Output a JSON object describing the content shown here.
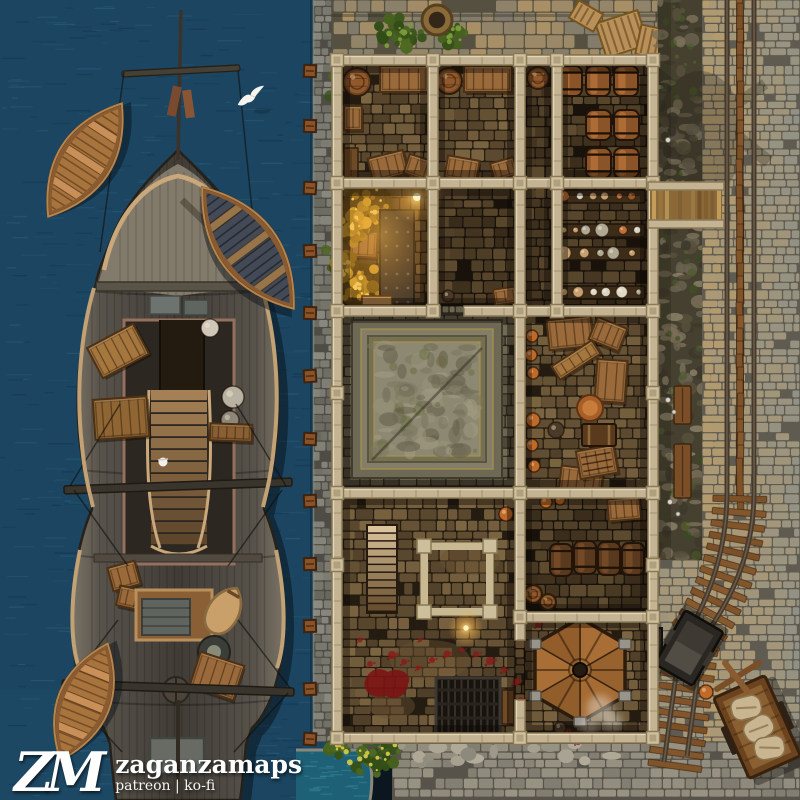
{
  "watermark": {
    "logo": "ZM",
    "name": "zaganzamaps",
    "links": "patreon | ko-fi"
  },
  "palette": {
    "water": "#1b4560",
    "water_light": "#2e5f7e",
    "water_dark": "#12344c",
    "inlet": "#1e6075",
    "stone_light": "#8b8a80",
    "stone_dark": "#66655c",
    "street_warm": "#b49b6e",
    "street_grey": "#8e9087",
    "beam": "#c4b494",
    "beam_edge": "#8a7a56",
    "barrel": "#8a5a2e",
    "crate": "#9a6a3a",
    "hay": "#d9a62f",
    "blood": "#8c1818",
    "rail": "#453a2e",
    "tie": "#7a4e26",
    "hull": "#4f4a3f",
    "boat": "#a8743e",
    "rig_tan": "#c9a87c"
  },
  "features": {
    "mooring_post_ys": [
      65,
      120,
      182,
      245,
      307,
      370,
      433,
      495,
      558,
      620,
      683,
      733
    ],
    "rooms": [
      {
        "x": 342,
        "y": 65,
        "w": 86,
        "h": 113,
        "pal": "warm"
      },
      {
        "x": 437,
        "y": 65,
        "w": 78,
        "h": 113,
        "pal": "warm"
      },
      {
        "x": 524,
        "y": 65,
        "w": 28,
        "h": 241,
        "pal": "dark"
      },
      {
        "x": 560,
        "y": 65,
        "w": 88,
        "h": 113,
        "pal": "dark"
      },
      {
        "x": 342,
        "y": 188,
        "w": 86,
        "h": 118,
        "pal": "stable"
      },
      {
        "x": 437,
        "y": 188,
        "w": 78,
        "h": 118,
        "pal": "dark"
      },
      {
        "x": 560,
        "y": 188,
        "w": 88,
        "h": 118,
        "pal": "dark"
      },
      {
        "x": 342,
        "y": 315,
        "w": 173,
        "h": 173,
        "pal": "court"
      },
      {
        "x": 524,
        "y": 315,
        "w": 124,
        "h": 173,
        "pal": "warm"
      },
      {
        "x": 342,
        "y": 497,
        "w": 173,
        "h": 236,
        "pal": "warm"
      },
      {
        "x": 524,
        "y": 497,
        "w": 124,
        "h": 115,
        "pal": "dark"
      },
      {
        "x": 524,
        "y": 620,
        "w": 124,
        "h": 113,
        "pal": "warm"
      }
    ],
    "walls": {
      "h": [
        [
          332,
          55,
          326
        ],
        [
          332,
          178,
          326
        ],
        [
          332,
          306,
          108
        ],
        [
          464,
          306,
          194
        ],
        [
          332,
          488,
          326
        ],
        [
          515,
          612,
          143
        ],
        [
          332,
          733,
          326
        ]
      ],
      "v": [
        [
          332,
          55,
          688
        ],
        [
          648,
          55,
          688
        ],
        [
          428,
          55,
          261
        ],
        [
          552,
          55,
          261
        ],
        [
          515,
          55,
          585
        ],
        [
          515,
          700,
          33
        ]
      ],
      "posts": [
        [
          332,
          55
        ],
        [
          428,
          55
        ],
        [
          515,
          55
        ],
        [
          552,
          55
        ],
        [
          648,
          55
        ],
        [
          332,
          178
        ],
        [
          428,
          178
        ],
        [
          515,
          178
        ],
        [
          552,
          178
        ],
        [
          648,
          178
        ],
        [
          332,
          306
        ],
        [
          428,
          306
        ],
        [
          515,
          306
        ],
        [
          552,
          306
        ],
        [
          648,
          306
        ],
        [
          332,
          488
        ],
        [
          515,
          488
        ],
        [
          648,
          488
        ],
        [
          515,
          612
        ],
        [
          648,
          612
        ],
        [
          332,
          733
        ],
        [
          515,
          733
        ],
        [
          648,
          733
        ],
        [
          332,
          388
        ],
        [
          648,
          388
        ],
        [
          332,
          560
        ],
        [
          648,
          560
        ]
      ]
    },
    "barrel_tops": [
      [
        357,
        82,
        14
      ],
      [
        449,
        81,
        13
      ],
      [
        538,
        78,
        11
      ],
      [
        533,
        594,
        9
      ],
      [
        548,
        602,
        8
      ]
    ],
    "barrels_upright": [
      [
        558,
        66,
        24,
        30
      ],
      [
        586,
        66,
        24,
        30
      ],
      [
        614,
        66,
        24,
        30
      ],
      [
        586,
        110,
        25,
        30
      ],
      [
        614,
        110,
        25,
        30
      ],
      [
        586,
        148,
        25,
        30
      ],
      [
        614,
        148,
        25,
        30
      ]
    ],
    "barrels_dark": [
      [
        550,
        544,
        22,
        32
      ],
      [
        574,
        541,
        22,
        33
      ],
      [
        598,
        542,
        22,
        33
      ],
      [
        622,
        543,
        22,
        32
      ]
    ],
    "crates": [
      [
        380,
        66,
        48,
        26,
        0
      ],
      [
        344,
        106,
        18,
        24,
        0
      ],
      [
        370,
        154,
        36,
        24,
        -14
      ],
      [
        406,
        158,
        30,
        20,
        18
      ],
      [
        464,
        66,
        48,
        26,
        0
      ],
      [
        446,
        158,
        32,
        22,
        10
      ],
      [
        492,
        160,
        24,
        18,
        -16
      ],
      [
        350,
        231,
        27,
        26,
        3
      ],
      [
        548,
        318,
        44,
        30,
        -6
      ],
      [
        592,
        322,
        32,
        24,
        22
      ],
      [
        596,
        360,
        30,
        42,
        4
      ],
      [
        560,
        468,
        42,
        26,
        7
      ],
      [
        608,
        498,
        32,
        22,
        -5
      ],
      [
        494,
        288,
        22,
        16,
        -8
      ]
    ],
    "crate_grids": [
      [
        578,
        448,
        38,
        28,
        -10
      ]
    ],
    "chests": [
      [
        582,
        424,
        34,
        22
      ]
    ],
    "copper_bowl": [
      590,
      408,
      13
    ],
    "bench_items": [
      [
        552,
        352,
        48,
        16,
        -33
      ]
    ],
    "shelf_rows": [
      [
        557,
        190,
        88
      ],
      [
        557,
        224,
        88
      ],
      [
        557,
        247,
        88
      ],
      [
        557,
        286,
        88
      ]
    ],
    "hay_clusters": [
      [
        368,
        208,
        26
      ],
      [
        352,
        228,
        17
      ],
      [
        360,
        284,
        24
      ],
      [
        344,
        266,
        15
      ]
    ],
    "metal_wall": [
      380,
      210,
      34,
      94
    ],
    "stable_sign": [
      362,
      296,
      30,
      9
    ],
    "doors": [
      [
        344,
        148,
        14,
        30
      ],
      [
        502,
        690,
        12,
        34
      ]
    ],
    "glow_points": [
      [
        417,
        197,
        9
      ],
      [
        466,
        628,
        6
      ]
    ],
    "stairs": [
      368,
      526,
      28,
      86
    ],
    "frame_square": [
      424,
      546,
      66,
      66
    ],
    "grate_rect": [
      436,
      678,
      64,
      56
    ],
    "hexagon": [
      580,
      670,
      52
    ],
    "platform": [
      352,
      320,
      150,
      158
    ],
    "pots_orange": [
      [
        532,
        336,
        6
      ],
      [
        531,
        355,
        6
      ],
      [
        533,
        373,
        6
      ],
      [
        533,
        420,
        7
      ],
      [
        532,
        445,
        6
      ],
      [
        534,
        466,
        6
      ],
      [
        546,
        502,
        6
      ],
      [
        560,
        500,
        5
      ],
      [
        506,
        514,
        7
      ],
      [
        706,
        692,
        7
      ]
    ],
    "pots_dark": [
      [
        556,
        430,
        8
      ],
      [
        560,
        728,
        6
      ],
      [
        448,
        296,
        6
      ]
    ],
    "blood_pool": [
      388,
      684
    ],
    "blood_splats": [
      [
        392,
        655,
        4
      ],
      [
        404,
        662,
        3
      ],
      [
        418,
        668,
        2.5
      ],
      [
        432,
        660,
        3
      ],
      [
        447,
        654,
        3.5
      ],
      [
        462,
        650,
        2.5
      ],
      [
        476,
        654,
        3
      ],
      [
        490,
        661,
        4
      ],
      [
        504,
        670,
        3
      ],
      [
        516,
        682,
        3.5
      ],
      [
        521,
        700,
        3
      ],
      [
        538,
        625,
        3
      ],
      [
        552,
        618,
        2.5
      ],
      [
        565,
        731,
        3.5
      ],
      [
        578,
        742,
        3
      ],
      [
        420,
        640,
        2
      ],
      [
        370,
        664,
        3
      ],
      [
        360,
        640,
        2.5
      ]
    ],
    "dirt_patches": [
      [
        430,
        660,
        80,
        40
      ],
      [
        392,
        706,
        46,
        26
      ],
      [
        470,
        560,
        60,
        30
      ]
    ],
    "smoke_puffs": [
      [
        600,
        708,
        13
      ],
      [
        612,
        722,
        10
      ],
      [
        590,
        726,
        9
      ]
    ],
    "street_benches": [
      [
        674,
        386,
        17,
        38
      ],
      [
        674,
        444,
        17,
        54
      ]
    ],
    "mushrooms": [
      [
        668,
        400,
        2.5
      ],
      [
        674,
        412,
        2
      ],
      [
        670,
        502,
        2.5
      ],
      [
        678,
        514,
        2
      ],
      [
        668,
        140,
        2.5
      ]
    ],
    "track": {
      "straight_x": 740,
      "curve": [
        [
          740,
          492
        ],
        [
          740,
          575
        ],
        [
          692,
          642
        ]
      ],
      "end": [
        676,
        758
      ]
    },
    "mine_cart": {
      "x": 689,
      "y": 648,
      "rot": 30,
      "w": 44,
      "h": 62
    },
    "supply_cart": {
      "x": 757,
      "y": 727,
      "rot": -24,
      "w": 56,
      "h": 88
    },
    "hand_cross": {
      "x": 737,
      "y": 677
    },
    "lamp_box": [
      641,
      628,
      21,
      27
    ],
    "ramp": [
      650,
      182,
      72,
      46
    ],
    "round_basket": [
      437,
      20,
      15
    ],
    "pallets": [
      [
        600,
        16,
        44,
        36,
        -18
      ],
      [
        638,
        28,
        36,
        30,
        12
      ],
      [
        572,
        6,
        28,
        20,
        30
      ]
    ],
    "bushes_top": [
      [
        402,
        32,
        26
      ],
      [
        452,
        34,
        18
      ]
    ],
    "bushes_inlet": [
      [
        370,
        754,
        30
      ],
      [
        340,
        747,
        14
      ]
    ],
    "vine_dots": [
      [
        333,
        76
      ],
      [
        330,
        96
      ],
      [
        336,
        86
      ],
      [
        326,
        250
      ],
      [
        330,
        268
      ],
      [
        334,
        258
      ]
    ],
    "inlet_path": "M296,750 L366,750 Q375,770 370,800 L296,800 Z",
    "ship": {
      "boats": [
        [
          85,
          160,
          135,
          54,
          -57,
          0
        ],
        [
          248,
          248,
          152,
          60,
          53,
          1
        ],
        [
          84,
          702,
          126,
          52,
          -68,
          0
        ]
      ],
      "gull": [
        252,
        97
      ],
      "deck_gull": [
        163,
        462
      ]
    }
  }
}
